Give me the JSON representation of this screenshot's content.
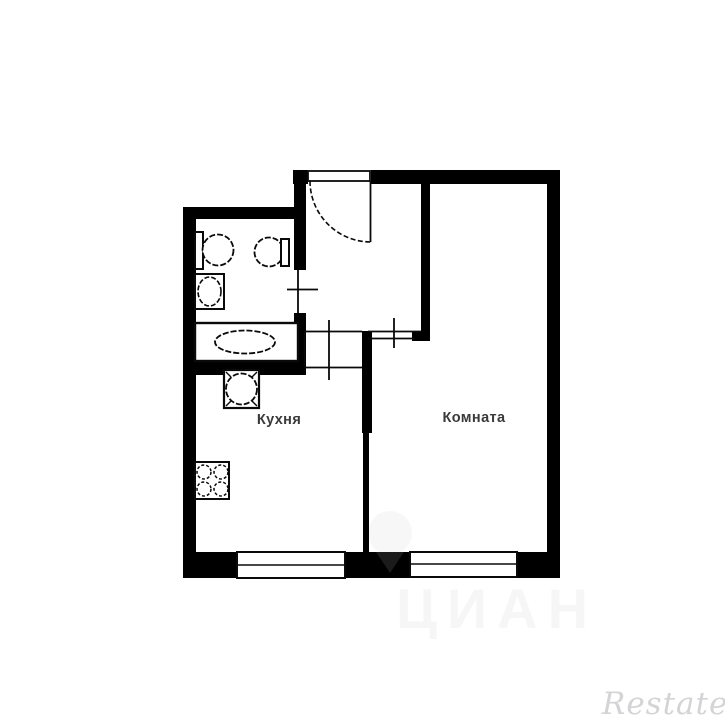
{
  "image": {
    "type": "apartment-floor-plan",
    "background_color": "#ffffff",
    "wall_color": "#000000",
    "line_color": "#0a0a0a",
    "label_color": "#3a3a3a"
  },
  "floorplan": {
    "rooms": [
      {
        "id": "kitchen",
        "label": "Кухня"
      },
      {
        "id": "room",
        "label": "Комната"
      },
      {
        "id": "bathroom",
        "label": ""
      },
      {
        "id": "hallway",
        "label": ""
      }
    ],
    "fixtures": [
      "toilet-left",
      "toilet-right",
      "washbasin",
      "bathtub",
      "kitchen-sink",
      "stove-4-burner"
    ],
    "doors": [
      "entrance-door-with-swing-arc",
      "bathroom-door",
      "kitchen-doorway",
      "room-doorway"
    ],
    "windows": [
      "kitchen-window",
      "room-window"
    ]
  },
  "watermarks": {
    "cian": "ЦИАН",
    "restate": "Restate"
  }
}
